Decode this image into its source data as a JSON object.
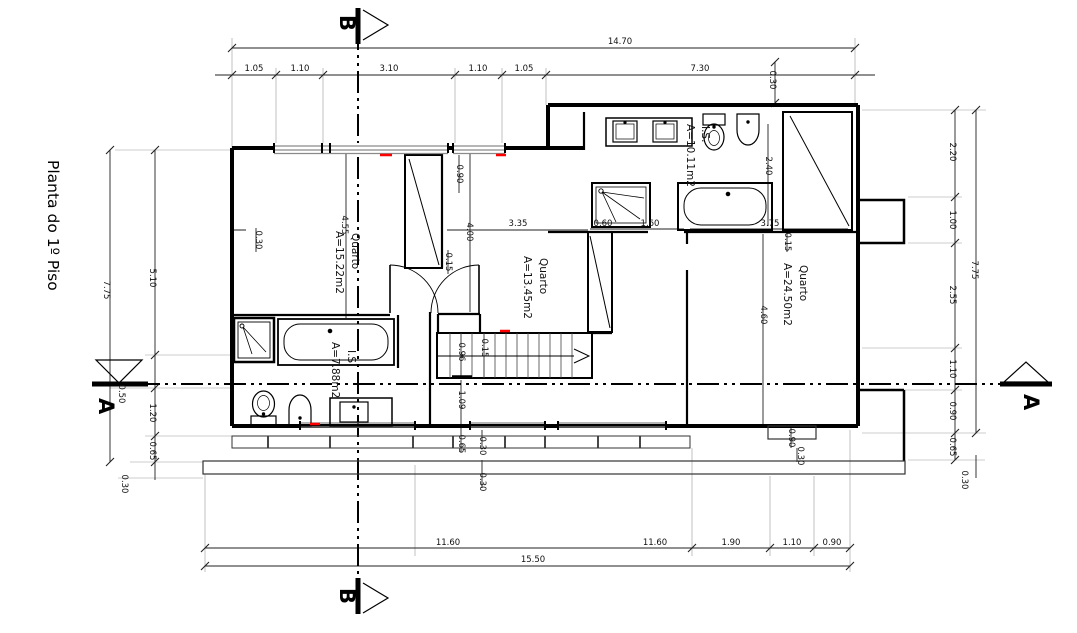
{
  "title": "Planta do 1º Piso",
  "section_markers": {
    "a": "A",
    "b": "B"
  },
  "rooms": [
    {
      "name": "Quarto",
      "area": "A=15.22m2"
    },
    {
      "name": "Quarto",
      "area": "A=13.45m2"
    },
    {
      "name": "Quarto",
      "area": "A=24.50m2"
    },
    {
      "name": "I.S.",
      "area": "A=10.11m2"
    },
    {
      "name": "I.S.",
      "area": "A=7.88m2"
    }
  ],
  "dims": {
    "top_total": "14.70",
    "top_chain": [
      "1.05",
      "1.10",
      "3.10",
      "1.10",
      "1.05",
      "7.30"
    ],
    "top_offset": "0.30",
    "left": [
      "7.75",
      "5.10",
      "0.50",
      "1.20",
      "0.65",
      "0.30"
    ],
    "right": [
      "2.20",
      "1.00",
      "2.55",
      "1.10",
      "0.90",
      "0.65",
      "7.75",
      "0.30"
    ],
    "bottom_chain": [
      "11.60",
      "11.60",
      "1.90",
      "1.10",
      "0.90"
    ],
    "bottom_total": "15.50",
    "interior": [
      "0.30",
      "4.55",
      "0.90",
      "4.00",
      "0.15",
      "3.35",
      "0.60",
      "1.60",
      "3.75",
      "0.15",
      "2.40",
      "4.60",
      "0.96",
      "0.15",
      "1.09",
      "0.65",
      "0.30",
      "0.30",
      "0.90",
      "0.30"
    ]
  },
  "colors": {
    "wall": "#000000",
    "dimension": "#1a1a1a",
    "window": "#8a8a8a",
    "accent_red": "#ff0000"
  }
}
